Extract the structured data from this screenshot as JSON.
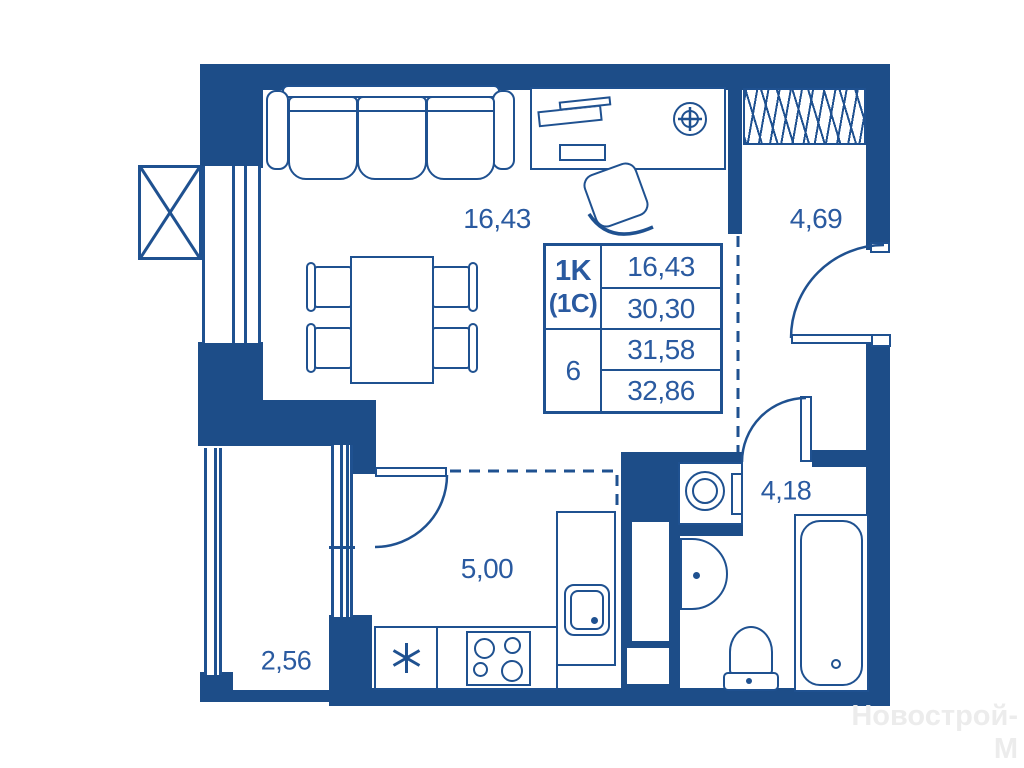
{
  "watermark": "Новострой-М",
  "info_table": {
    "apartment_type": "1K",
    "apartment_subtype": "(1C)",
    "floor": "6",
    "area_living": "16,43",
    "area_main": "30,30",
    "area_total": "31,58",
    "area_total_with_balcony": "32,86"
  },
  "rooms": {
    "living": {
      "area": "16,43"
    },
    "hallway": {
      "area": "4,69"
    },
    "bathroom": {
      "area": "4,18"
    },
    "kitchen": {
      "area": "5,00"
    },
    "balcony": {
      "area": "2,56"
    }
  },
  "symbols": {
    "fridge_asterisk": "*"
  },
  "colors": {
    "wall": "#1d4d88",
    "line": "#1f5190",
    "text": "#2a5aa0",
    "watermark": "#ececec",
    "background": "#ffffff"
  }
}
